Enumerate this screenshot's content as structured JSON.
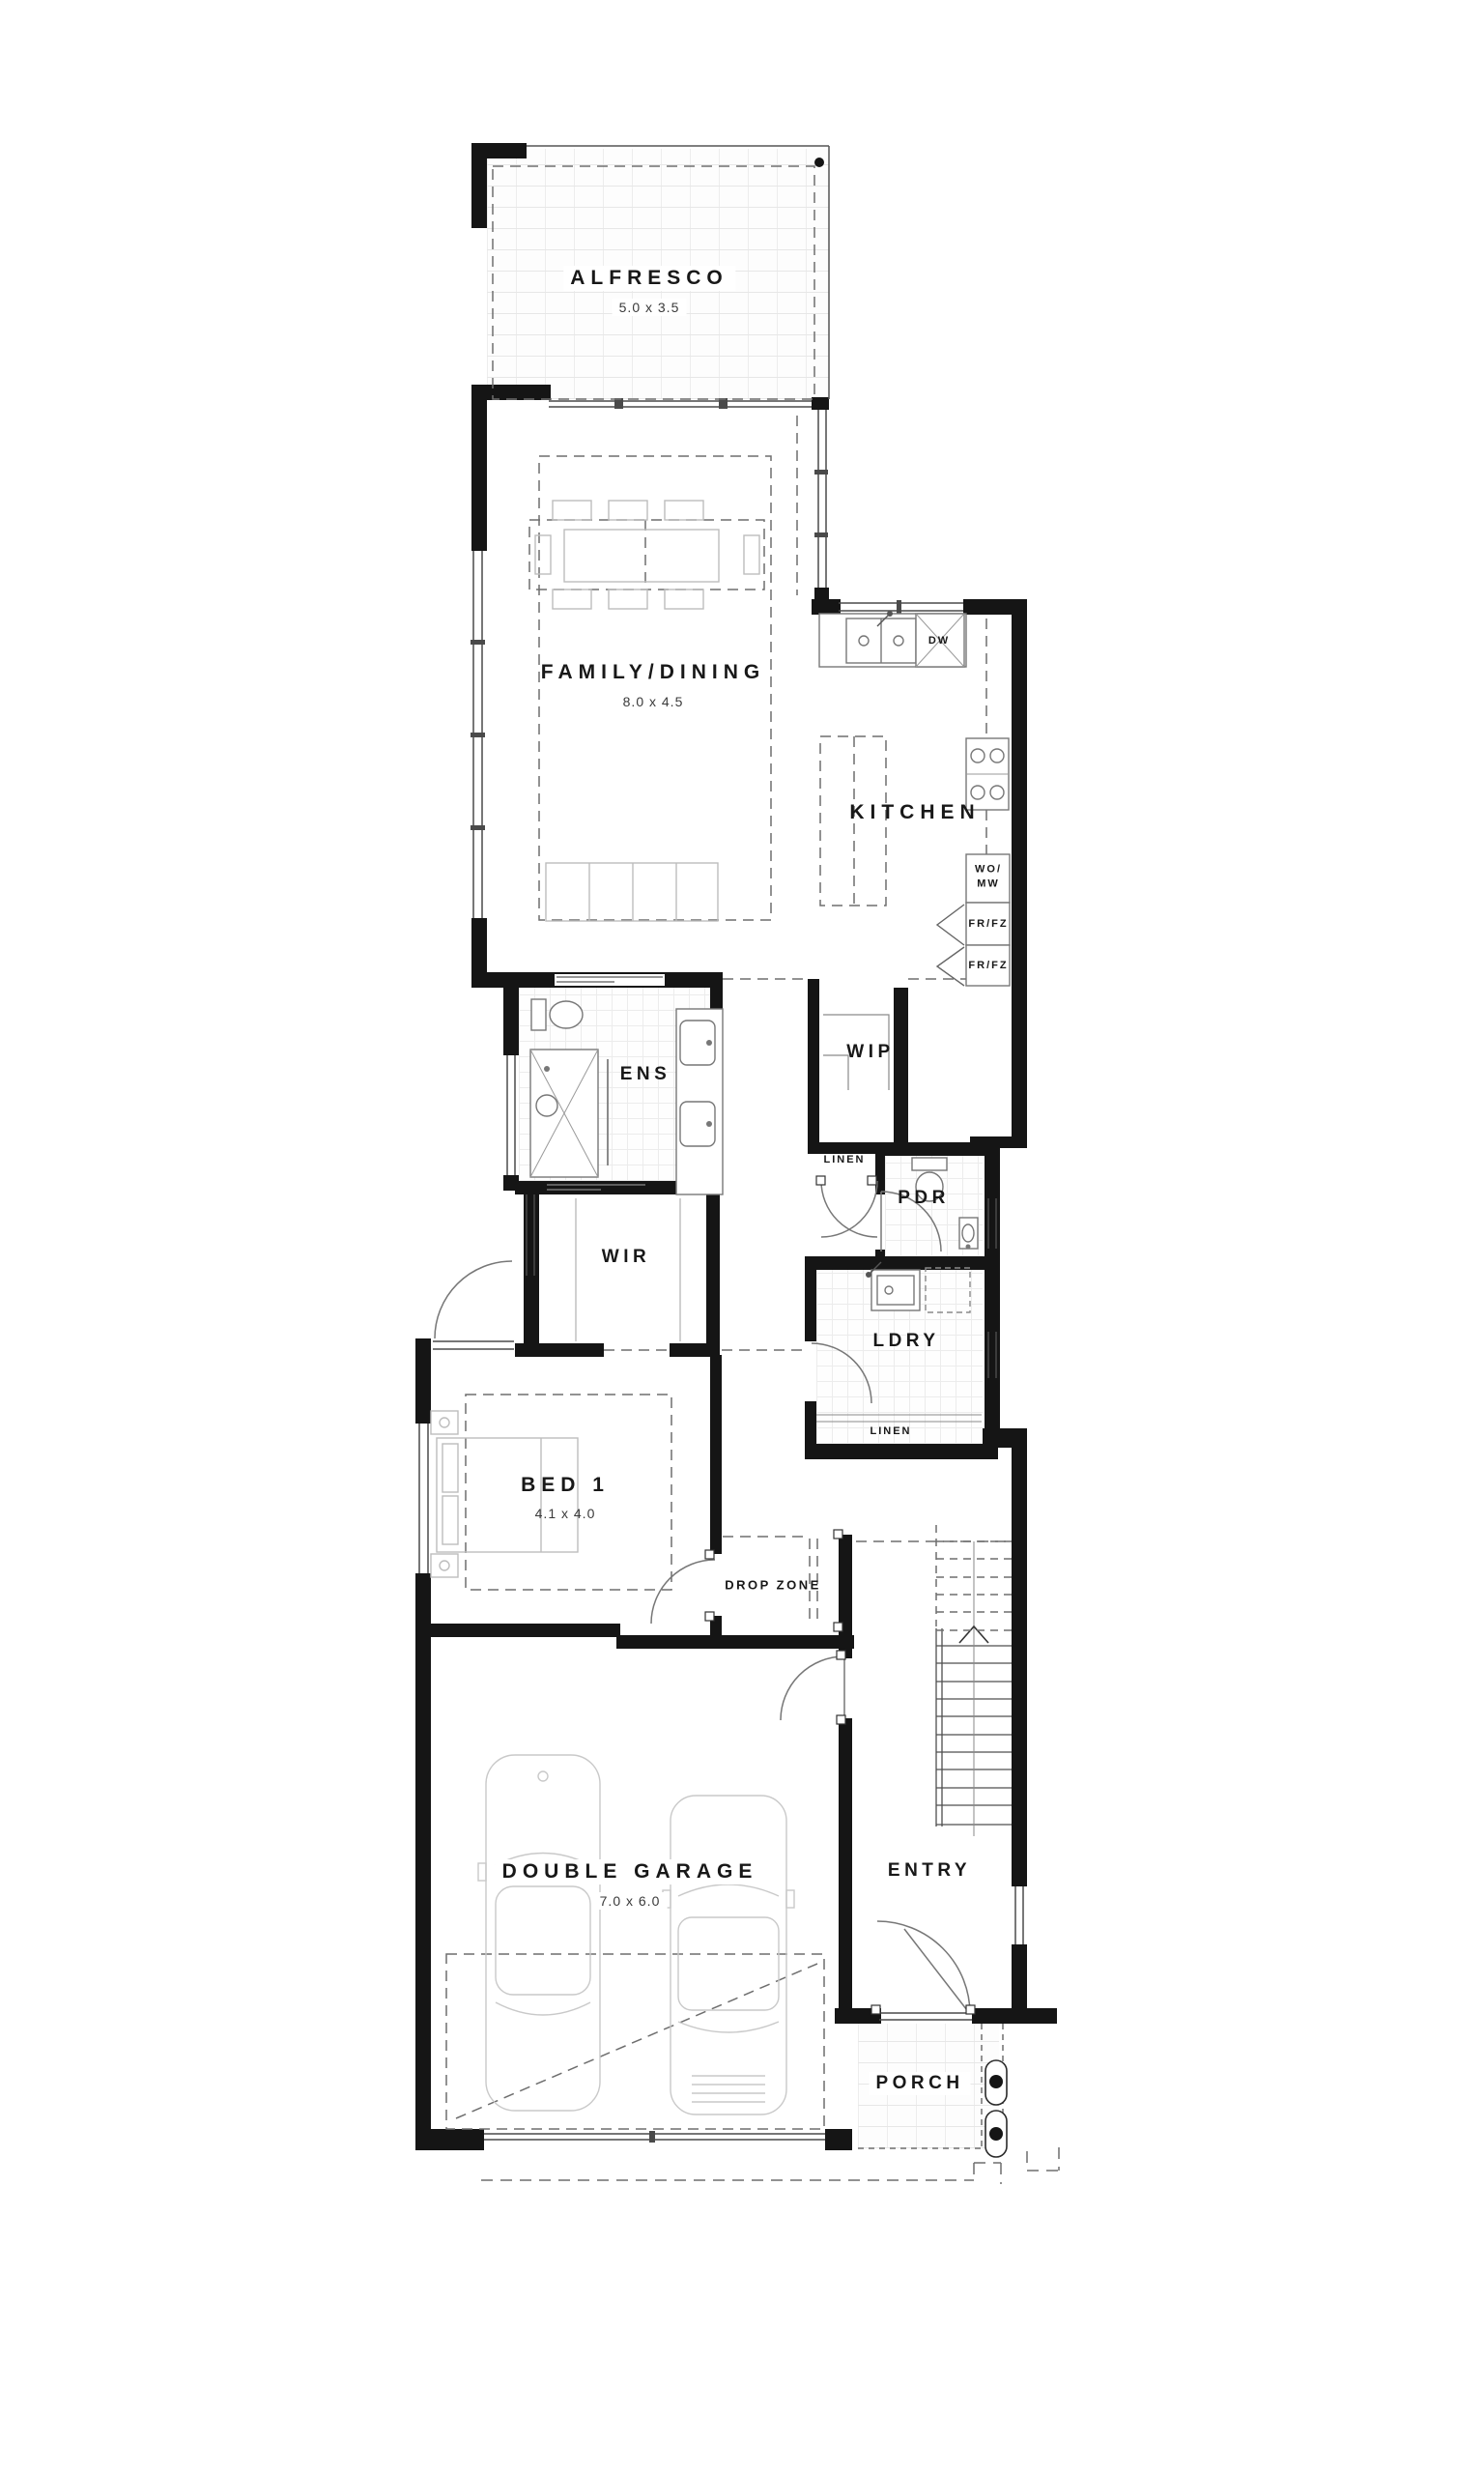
{
  "plan": {
    "rooms": {
      "alfresco": {
        "label": "ALFRESCO",
        "dims": "5.0 x 3.5"
      },
      "family_dining": {
        "label": "FAMILY/DINING",
        "dims": "8.0 x 4.5"
      },
      "kitchen": {
        "label": "KITCHEN"
      },
      "ens": {
        "label": "ENS"
      },
      "wip": {
        "label": "WIP"
      },
      "wir": {
        "label": "WIR"
      },
      "pdr": {
        "label": "PDR"
      },
      "ldry": {
        "label": "LDRY"
      },
      "bed1": {
        "label": "BED 1",
        "dims": "4.1 x 4.0"
      },
      "drop_zone": {
        "label": "DROP ZONE"
      },
      "garage": {
        "label": "DOUBLE GARAGE",
        "dims": "7.0 x 6.0"
      },
      "entry": {
        "label": "ENTRY"
      },
      "porch": {
        "label": "PORCH"
      }
    },
    "fixtures": {
      "dw": "DW",
      "wo": "WO/",
      "mw": "MW",
      "fr_fz_upper": "FR/FZ",
      "fr_fz_lower": "FR/FZ",
      "linen_upper": "LINEN",
      "linen_lower": "LINEN"
    },
    "colors": {
      "wall": "#151515",
      "thin_line": "#555555",
      "dashed_line": "#6e6e6e",
      "furniture": "#bdbdbd",
      "car_outline": "#c9c9c9"
    }
  }
}
